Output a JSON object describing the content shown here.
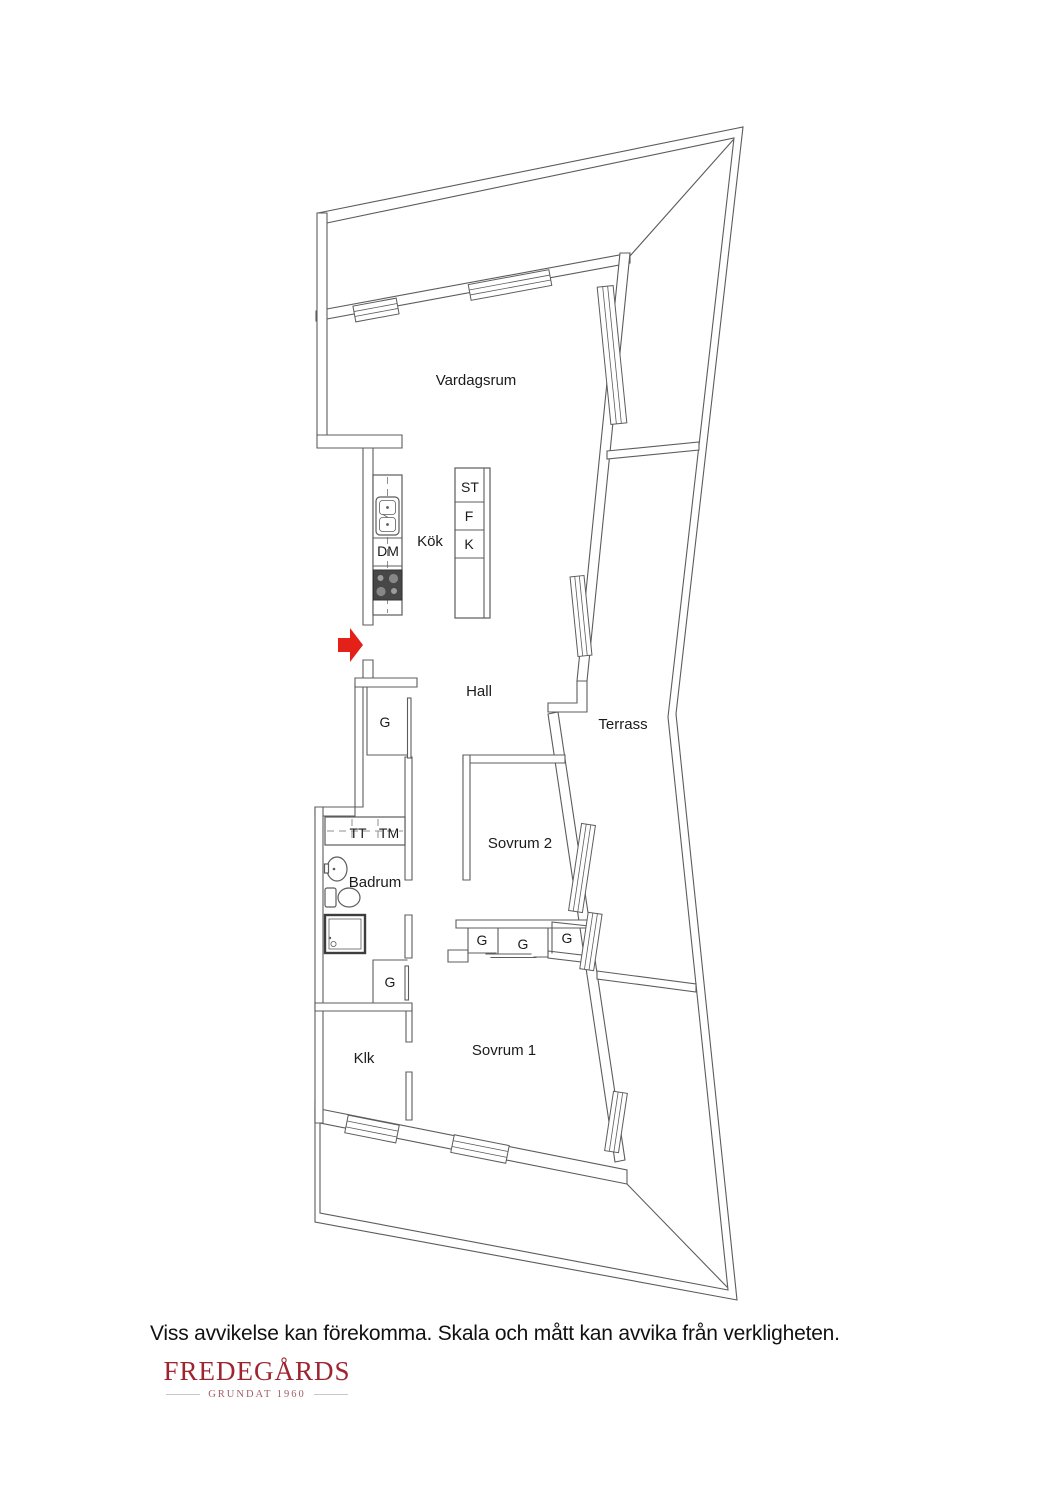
{
  "labels": {
    "living_room": "Vardagsrum",
    "kitchen": "Kök",
    "hall": "Hall",
    "terrace": "Terrass",
    "bedroom2": "Sovrum 2",
    "bedroom1": "Sovrum 1",
    "bathroom": "Badrum",
    "walk_in_closet": "Klk",
    "wardrobe": "G",
    "dishwasher": "DM",
    "cleaning_cabinet": "ST",
    "fridge": "F",
    "freezer": "K",
    "dryer": "TT",
    "washer": "TM"
  },
  "footer": {
    "disclaimer": "Viss avvikelse kan förekomma. Skala och mått kan avvika från verkligheten."
  },
  "brand": {
    "name": "FREDEGÅRDS",
    "tagline": "GRUNDAT 1960"
  },
  "colors": {
    "wall_line": "#5c5c5c",
    "entrance_arrow": "#e32119",
    "logo_red": "#9e2430"
  }
}
